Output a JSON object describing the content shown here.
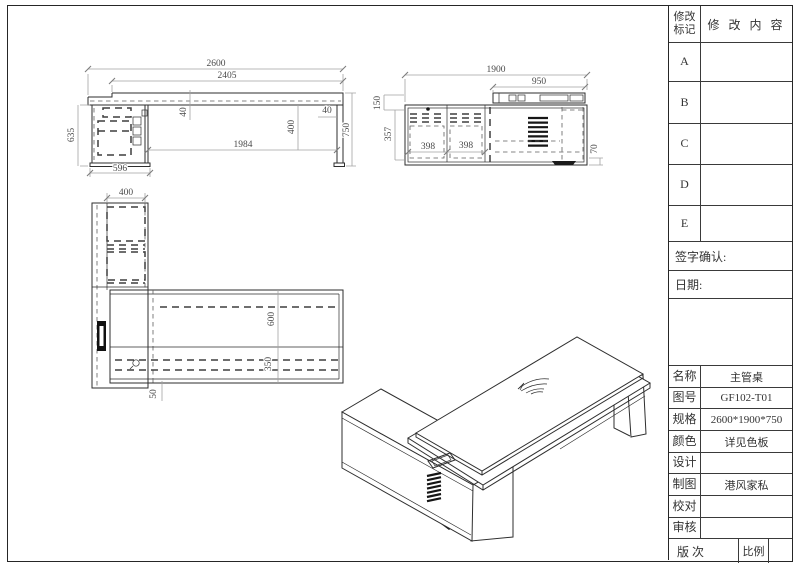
{
  "revision": {
    "mark_header": [
      "修改",
      "标记"
    ],
    "content_header": "修 改 内 容",
    "rows": [
      "A",
      "B",
      "C",
      "D",
      "E"
    ],
    "signature": "签字确认:",
    "date": "日期:"
  },
  "title_block": {
    "name_label": "名称",
    "name_value": "主管桌",
    "drawing_no_label": "图号",
    "drawing_no_value": "GF102-T01",
    "spec_label": "规格",
    "spec_value": "2600*1900*750",
    "color_label": "颜色",
    "color_value": "详见色板",
    "design_label": "设计",
    "design_value": "",
    "draft_label": "制图",
    "draft_value": "港风家私",
    "proof_label": "校对",
    "proof_value": "",
    "audit_label": "审核",
    "audit_value": "",
    "version_label": "版次",
    "scale_label": "比例",
    "scale_value": ""
  },
  "dims": {
    "front": {
      "overall_width": "2600",
      "top_width": "2405",
      "top_thickness": "40",
      "apron_drop": "400",
      "leg_thickness": "40",
      "height": "750",
      "clear_span": "1984",
      "cabinet_height": "635",
      "cabinet_width": "596"
    },
    "side": {
      "overall_depth": "1900",
      "top_depth": "950",
      "top_offset": "150",
      "drawer_height": "357",
      "drawer_w1": "398",
      "drawer_w2": "398",
      "base_height": "70"
    },
    "top": {
      "cabinet_depth": "400",
      "desk_depth": "600",
      "inner_depth": "350",
      "edge_gap": "50"
    }
  },
  "colors": {
    "line": "#2e2e2e",
    "dim_line": "#a3a3a3",
    "dim_text": "#4a4a4a",
    "paper": "#ffffff"
  }
}
